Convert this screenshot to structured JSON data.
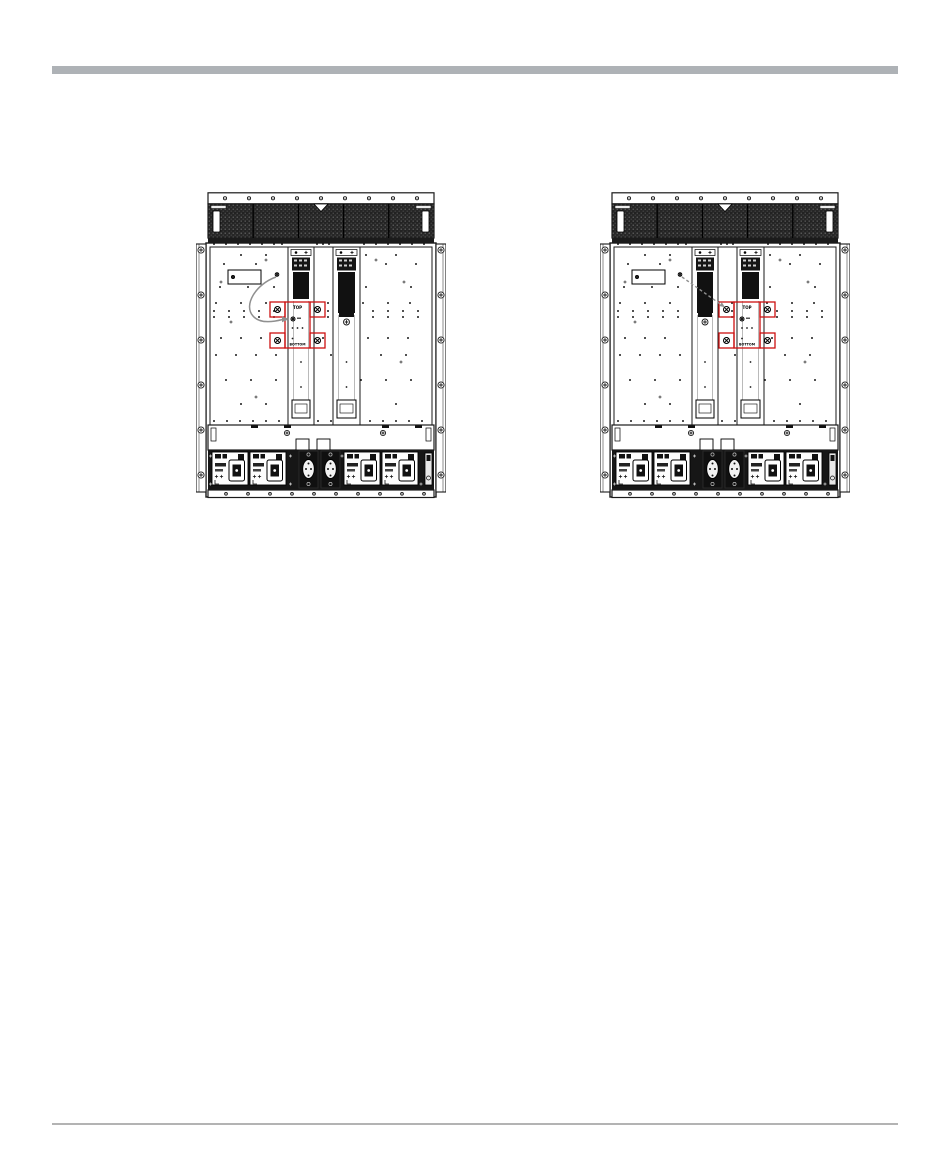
{
  "page": {
    "background": "#ffffff"
  },
  "header_rule": {
    "color": "#aeb2b6"
  },
  "footer_rule": {
    "color": "#b3b3b3"
  },
  "diagram": {
    "ink": "#1a1a1a",
    "panel": "#ffffff",
    "mesh_dark": "#262626",
    "block_dark": "#111111",
    "accent_red": "#cc1111",
    "arrow_gray": "#909090"
  },
  "figures": [
    {
      "name": "chassis-rear-first-slot-highlight",
      "highlight_slot": 0,
      "arrow": "curved",
      "labels": {
        "top": "TOP",
        "bottom": "BOTTOM"
      }
    },
    {
      "name": "chassis-rear-second-slot-highlight",
      "highlight_slot": 1,
      "arrow": "dashed",
      "labels": {
        "top": "TOP",
        "bottom": "BOTTOM"
      }
    }
  ]
}
